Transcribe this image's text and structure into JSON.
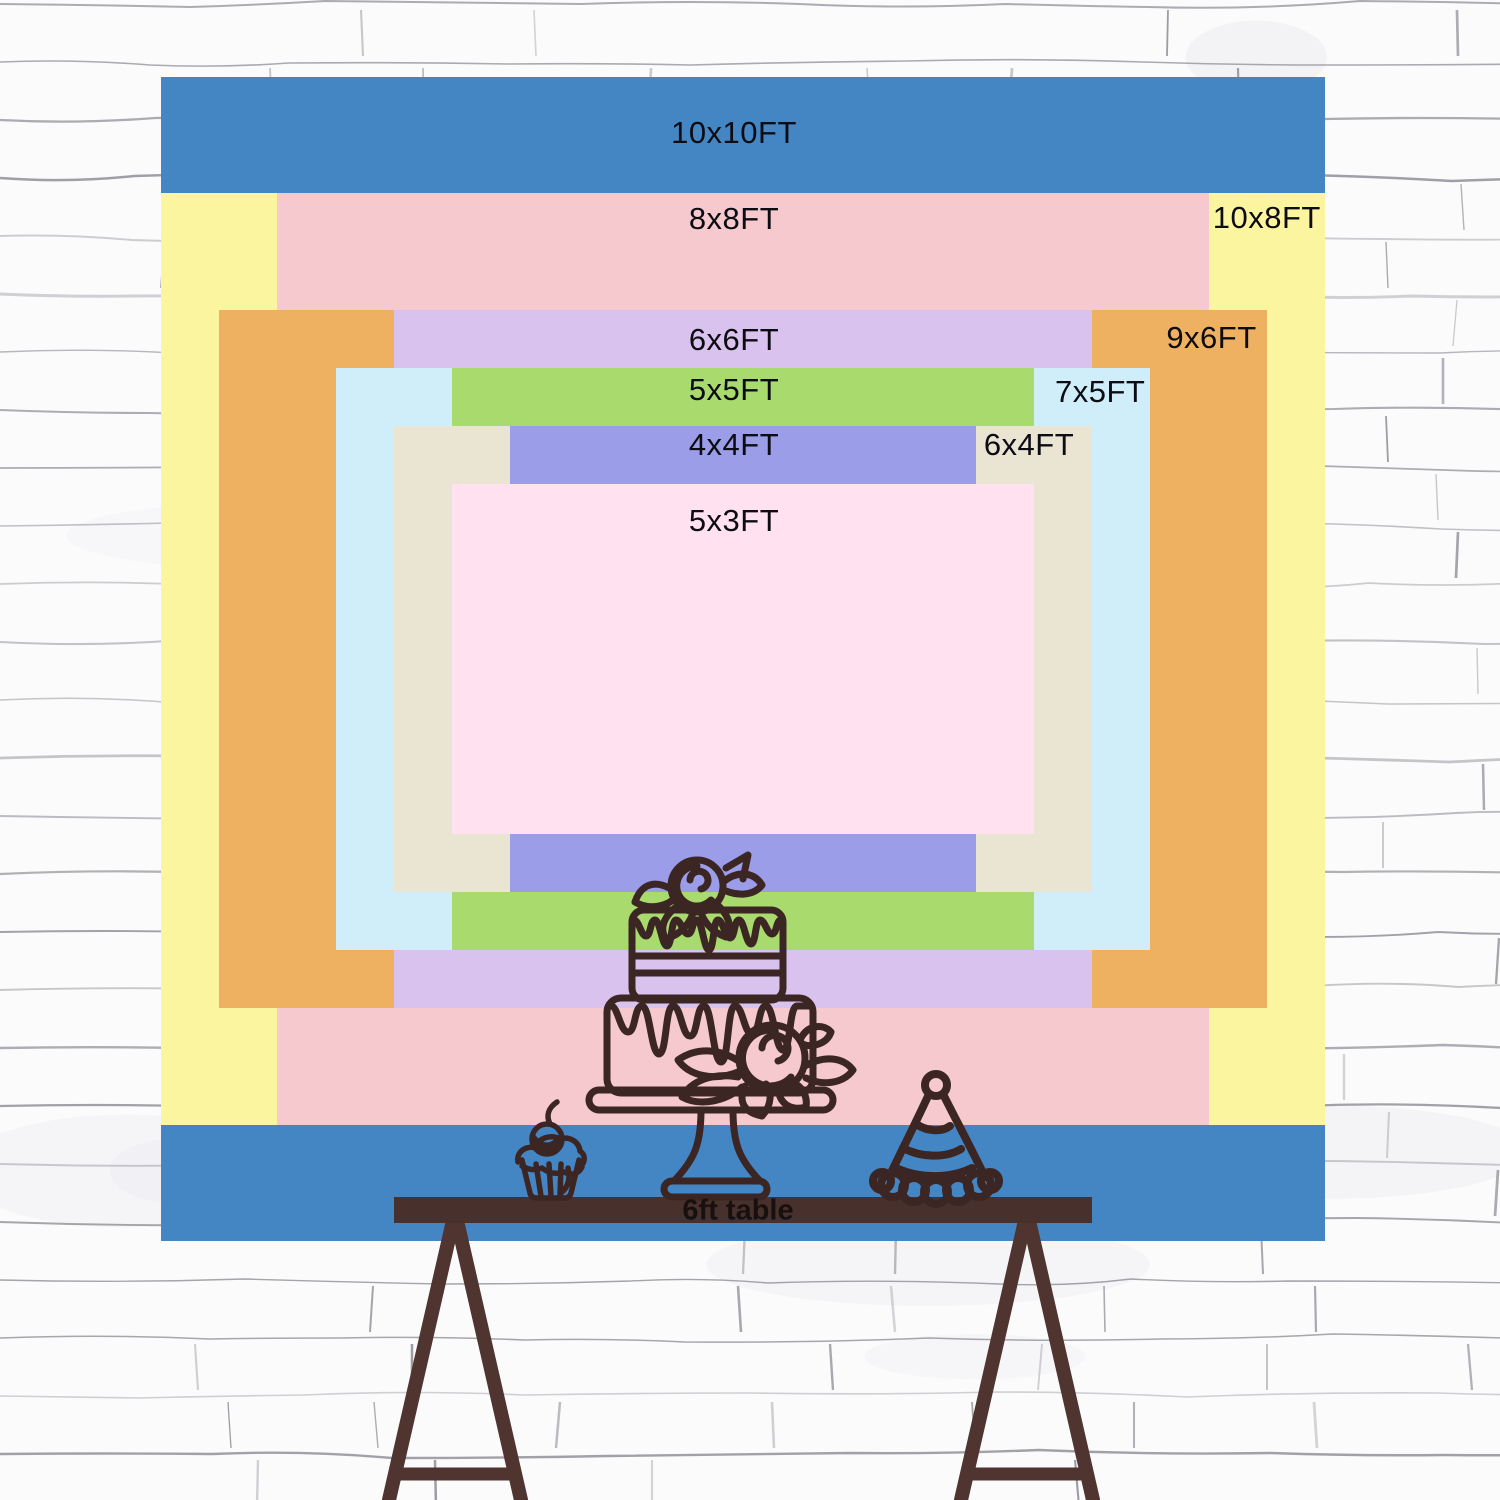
{
  "backdrop_chart": {
    "unit": "FT",
    "description": "Nested backdrop size comparison rectangles, all centered",
    "sizes": [
      {
        "label": "10x10FT",
        "width_ft": 10,
        "height_ft": 10,
        "color": "#4486c4",
        "label_placement": "top-center"
      },
      {
        "label": "10x8FT",
        "width_ft": 10,
        "height_ft": 8,
        "color": "#fcf5a0",
        "label_placement": "right-margin"
      },
      {
        "label": "8x8FT",
        "width_ft": 8,
        "height_ft": 8,
        "color": "#f5c9cd",
        "label_placement": "top-center"
      },
      {
        "label": "9x6FT",
        "width_ft": 9,
        "height_ft": 6,
        "color": "#eeb162",
        "label_placement": "right-margin"
      },
      {
        "label": "6x6FT",
        "width_ft": 6,
        "height_ft": 6,
        "color": "#dac2ef",
        "label_placement": "top-center"
      },
      {
        "label": "7x5FT",
        "width_ft": 7,
        "height_ft": 5,
        "color": "#cfeef9",
        "label_placement": "right-margin"
      },
      {
        "label": "5x5FT",
        "width_ft": 5,
        "height_ft": 5,
        "color": "#a9da6e",
        "label_placement": "top-center"
      },
      {
        "label": "6x4FT",
        "width_ft": 6,
        "height_ft": 4,
        "color": "#eae4d3",
        "label_placement": "right-margin"
      },
      {
        "label": "4x4FT",
        "width_ft": 4,
        "height_ft": 4,
        "color": "#9b9de9",
        "label_placement": "top-center"
      },
      {
        "label": "5x3FT",
        "width_ft": 5,
        "height_ft": 3,
        "color": "#ffe1ef",
        "label_placement": "top-center"
      }
    ],
    "label_text_color": "#0c0c12"
  },
  "table": {
    "label": "6ft table",
    "top_color": "#48302c",
    "leg_color": "#50342f"
  },
  "illustrations": {
    "cake": "two-tier-cake-with-roses-line-drawing",
    "cupcake": "cupcake-with-cherry-line-drawing",
    "party_hat": "striped-party-hat-line-drawing",
    "stroke_color": "#3b2624"
  },
  "wall": {
    "style": "white-painted-brick",
    "base_color": "#fbfbfc",
    "mortar_color": "#83838c"
  }
}
